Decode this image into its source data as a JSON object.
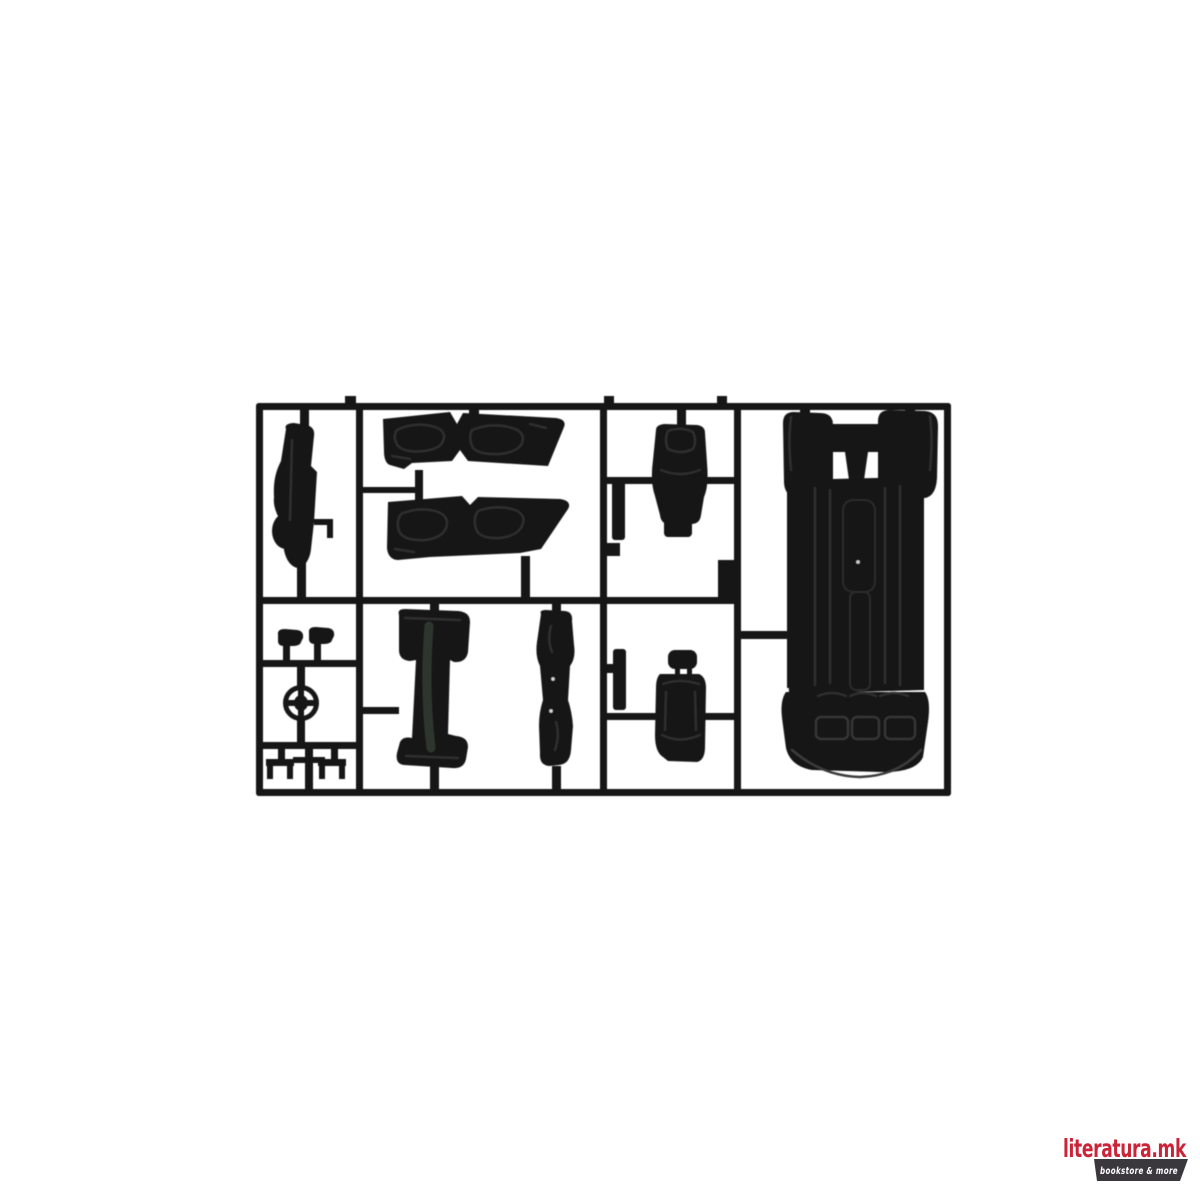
{
  "page": {
    "background_color": "#ffffff"
  },
  "photo": {
    "subject": "Black plastic model kit sprue (injection-molded parts tree) with scale car interior parts on a white background",
    "plastic_color": "#141414",
    "parts": [
      "dashboard side view",
      "upper door interior panel pair",
      "lower door interior panel pair",
      "bucket seat back with base pad",
      "bucket seat with headrest",
      "chassis floor pan with wheel arches and rear bench",
      "center console left",
      "center console right",
      "steering wheel",
      "headrest small",
      "headrest small 2",
      "mounting clip left",
      "mounting clip right"
    ]
  },
  "watermark": {
    "brand": "literatura.mk",
    "tagline": "bookstore & more",
    "brand_color": "#cb2439",
    "badge_color": "#3b383d",
    "tagline_color": "#ffffff"
  }
}
